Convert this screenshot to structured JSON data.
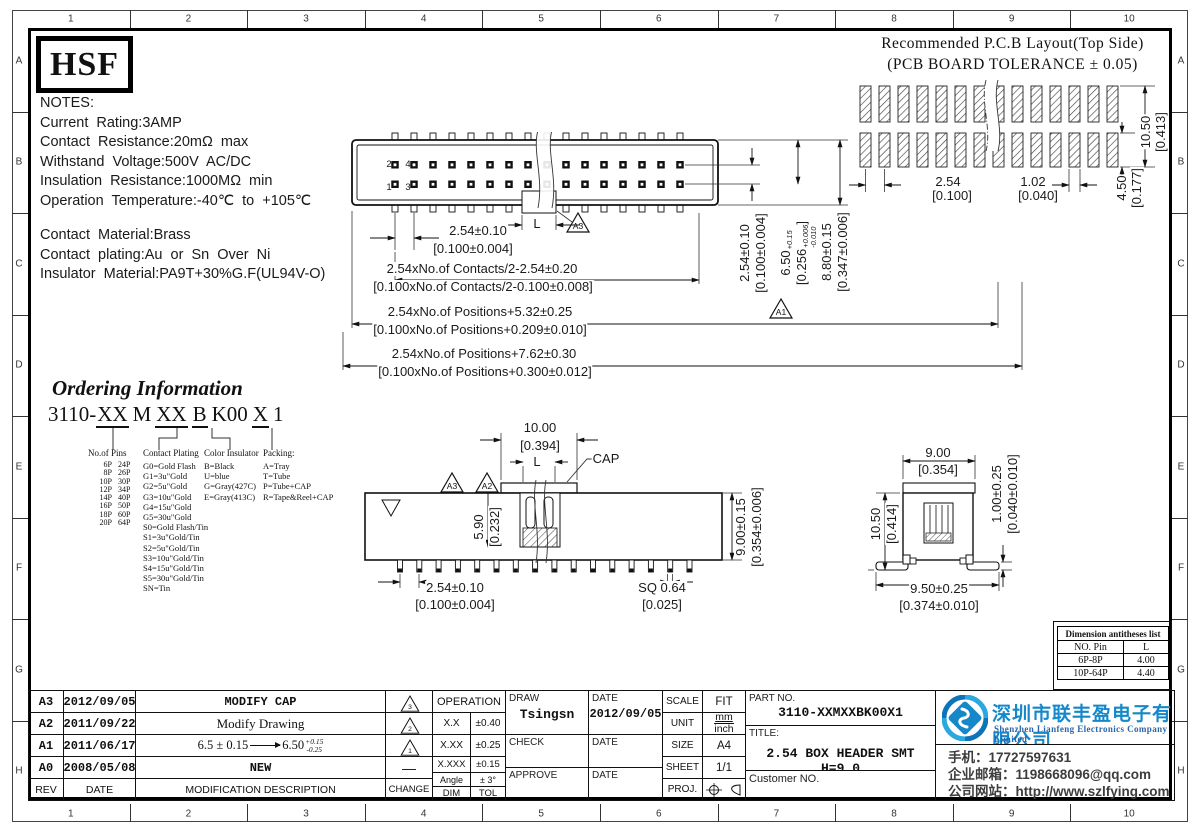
{
  "sheet": {
    "cols": [
      "1",
      "2",
      "3",
      "4",
      "5",
      "6",
      "7",
      "8",
      "9",
      "10"
    ],
    "rows": [
      "A",
      "B",
      "C",
      "D",
      "E",
      "F",
      "G",
      "H"
    ]
  },
  "logo": {
    "text": "HSF"
  },
  "notes": {
    "lines": [
      "NOTES:",
      "Current Rating:3AMP",
      "Contact Resistance:20mΩ  max",
      "Withstand Voltage:500V AC/DC",
      "Insulation Resistance:1000MΩ min",
      "Operation Temperature:-40℃ to +105℃"
    ],
    "material": [
      "Contact Material:Brass",
      "Contact plating:Au or Sn Over Ni",
      "Insulator Material:PA9T+30%G.F(UL94V-O)"
    ]
  },
  "pcb": {
    "title1": "Recommended P.C.B Layout(Top Side)",
    "title2": "(PCB BOARD TOLERANCE ± 0.05)"
  },
  "ordering": {
    "title": "Ordering Information",
    "part": {
      "s1": "3110-",
      "u1": "XX",
      "s2": "M",
      "u2": "XX",
      "u3": "B",
      "s3": "K00",
      "u4": "X",
      "s4": "1"
    },
    "pins": {
      "header": "No.of Pins",
      "rows": [
        [
          "6P",
          "24P"
        ],
        [
          "8P",
          "26P"
        ],
        [
          "10P",
          "30P"
        ],
        [
          "12P",
          "34P"
        ],
        [
          "14P",
          "40P"
        ],
        [
          "16P",
          "50P"
        ],
        [
          "18P",
          "60P"
        ],
        [
          "20P",
          "64P"
        ]
      ]
    },
    "plating": {
      "header": "Contact Plating",
      "items": [
        "G0=Gold Flash",
        "G1=3u\"Gold",
        "G2=5u\"Gold",
        "G3=10u\"Gold",
        "G4=15u\"Gold",
        "G5=30u\"Gold",
        "S0=Gold Flash/Tin",
        "S1=3u\"Gold/Tin",
        "S2=5u\"Gold/Tin",
        "S3=10u\"Gold/Tin",
        "S4=15u\"Gold/Tin",
        "S5=30u\"Gold/Tin",
        "SN=Tin"
      ]
    },
    "color": {
      "header": "Color Insulator",
      "items": [
        "B=Black",
        "U=blue",
        "G=Gray(427C)",
        "E=Gray(413C)"
      ]
    },
    "packing": {
      "header": "Packing:",
      "items": [
        "A=Tray",
        "T=Tube",
        "P=Tube+CAP",
        "R=Tape&Reel+CAP"
      ]
    }
  },
  "annot": {
    "tv_r1a": "2.54±0.10",
    "tv_r1b": "[0.100±0.004]",
    "tv_r2a": "2.54xNo.of Contacts/2-2.54±0.20",
    "tv_r2b": "[0.100xNo.of Contacts/2-0.100±0.008]",
    "tv_r3a": "2.54xNo.of Positions+5.32±0.25",
    "tv_r3b": "[0.100xNo.of Positions+0.209±0.010]",
    "tv_r4a": "2.54xNo.of Positions+7.62±0.30",
    "tv_r4b": "[0.100xNo.of Positions+0.300±0.012]",
    "tv_l": "L",
    "tv_v1a": "2.54±0.10",
    "tv_v1b": "[0.100±0.004]",
    "tv_v3a": "8.80±0.15",
    "tv_v3b": "[0.347±0.006]",
    "t650_main": "6.50",
    "t650_sup": "+0.15",
    "t650_sub": "-0.25",
    "t256_main": "[0.256",
    "t256_sup": "+0.006",
    "t256_sub": "-0.010",
    "t256_close": "]",
    "pcb_p": "2.54",
    "pcb_pb": "[0.100]",
    "pcb_w": "1.02",
    "pcb_wb": "[0.040]",
    "pcb_h": "10.50",
    "pcb_hb": "[0.413]",
    "pcb_g": "4.50",
    "pcb_gb": "[0.177]",
    "fv_10": "10.00",
    "fv_10b": "[0.394]",
    "fv_l": "L",
    "fv_cap": "CAP",
    "fv_59": "5.90",
    "fv_59b": "[0.232]",
    "fv_9": "9.00±0.15",
    "fv_9b": "[0.354±0.006]",
    "fv_254": "2.54±0.10",
    "fv_254b": "[0.100±0.004]",
    "fv_sq": "SQ 0.64",
    "fv_sqb": "[0.025]",
    "sv_9": "9.00",
    "sv_9b": "[0.354]",
    "sv_105": "10.50",
    "sv_105b": "[0.414]",
    "sv_1": "1.00±0.25",
    "sv_1b": "[0.040±0.010]",
    "sv_95": "9.50±0.25",
    "sv_95b": "[0.374±0.010]",
    "tv_p1": "1",
    "tv_p2": "2",
    "tv_p3": "3",
    "tv_p4": "4",
    "flag_tv_a3": "A3",
    "flag_tv_a1": "A1",
    "flag_fv_a3": "A3",
    "flag_fv_a2": "A2"
  },
  "dim_table": {
    "title": "Dimension antitheses list",
    "col1": "NO. Pin",
    "col2": "L",
    "rows": [
      [
        "6P-8P",
        "4.00"
      ],
      [
        "10P-64P",
        "4.40"
      ]
    ]
  },
  "revision": {
    "header": {
      "rev": "REV",
      "date": "DATE",
      "desc": "MODIFICATION DESCRIPTION",
      "change": "CHANGE"
    },
    "rows": [
      {
        "rev": "A3",
        "date": "2012/09/05",
        "desc": "MODIFY CAP",
        "flag": "3"
      },
      {
        "rev": "A2",
        "date": "2011/09/22",
        "desc": "Modify Drawing",
        "flag": "2"
      },
      {
        "rev": "A1",
        "date": "2011/06/17",
        "desc": "",
        "flag": "1"
      },
      {
        "rev": "A0",
        "date": "2008/05/08",
        "desc": "NEW",
        "dash": "—"
      }
    ],
    "a1_desc": {
      "pre": "6.5 ± 0.15",
      "main": "6.50",
      "sup": "+0.15",
      "sub": "-0.25"
    }
  },
  "tolerance": {
    "header": "OPERATION",
    "rows": [
      [
        "X.X",
        "±0.40"
      ],
      [
        "X.XX",
        "±0.25"
      ],
      [
        "X.XXX",
        "±0.15"
      ],
      [
        "Angle",
        "± 3°"
      ]
    ],
    "footer": [
      "DIM",
      "TOL"
    ]
  },
  "approval": {
    "draw": "DRAW",
    "date": "DATE",
    "check": "CHECK",
    "approve": "APPROVE",
    "drawer": "Tsingsn",
    "draw_date": "2012/09/05"
  },
  "info": {
    "scale": "SCALE",
    "scale_v": "FIT",
    "unit": "UNIT",
    "unit_mm": "mm",
    "unit_inch": "inch",
    "size": "SIZE",
    "size_v": "A4",
    "sheet": "SHEET",
    "sheet_v": "1/1",
    "proj": "PROJ."
  },
  "part": {
    "label": "PART NO.",
    "value": "3110-XXMXXBK00X1",
    "title_label": "TITLE:",
    "title": "2.54 BOX HEADER SMT H=9.0",
    "customer": "Customer NO."
  },
  "company": {
    "cn": "深圳市联丰盈电子有限公司",
    "en": "Shenzhen Lianfeng Electronics Company Limited",
    "phone": "手机：17727597631",
    "email": "企业邮箱：1198668096@qq.com",
    "web": "公司网站：http://www.szlfying.com"
  },
  "colors": {
    "brand_blue": "#1588c9",
    "logo_light": "#29a9e0",
    "logo_dark": "#0d74ba"
  },
  "figure": {
    "pcb_pads_per_row": 14,
    "tv_pin_cols": 16,
    "fv_pin_count": 16
  }
}
